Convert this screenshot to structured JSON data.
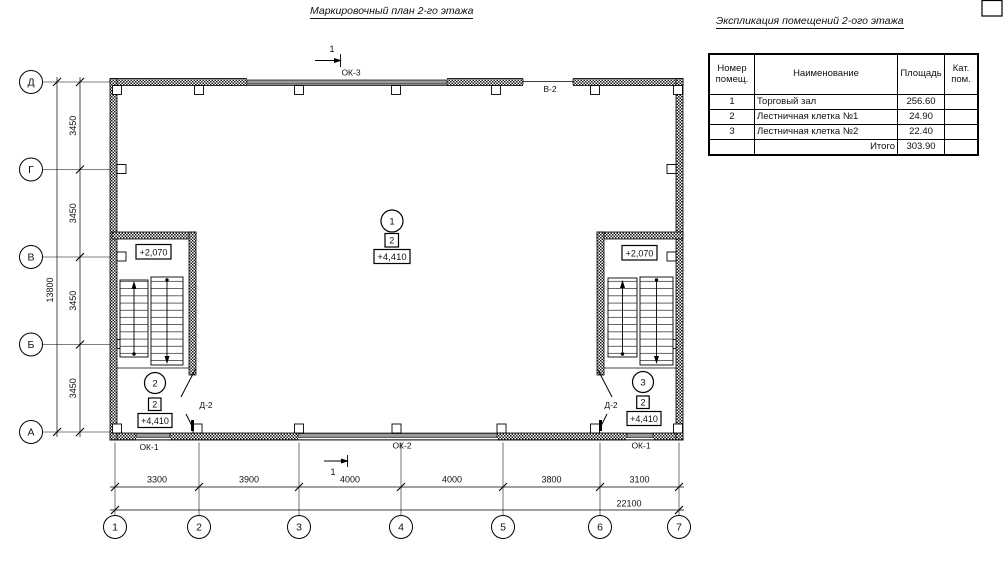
{
  "plan": {
    "title": "Маркировочный план 2-го этажа",
    "section_mark": "1",
    "labels": {
      "ok3": "ОК-3",
      "v2": "В-2",
      "ok1_left": "ОК-1",
      "ok2": "ОК-2",
      "ok1_right": "ОК-1",
      "d2_left": "Д-2",
      "d2_right": "Д-2"
    },
    "axes": {
      "rows": [
        "Д",
        "Г",
        "В",
        "Б",
        "А"
      ],
      "cols": [
        "1",
        "2",
        "3",
        "4",
        "5",
        "6",
        "7"
      ]
    },
    "dimensions": {
      "v_segments": [
        "3450",
        "3450",
        "3450",
        "3450"
      ],
      "v_total": "13800",
      "h_segments": [
        "3300",
        "3900",
        "4000",
        "4000",
        "3800",
        "3100"
      ],
      "h_total": "22100"
    },
    "markers": {
      "room1": {
        "number": "1",
        "category": "2",
        "elevation": "+4,410"
      },
      "room2": {
        "number": "2",
        "category": "2",
        "elevation": "+4,410"
      },
      "room3": {
        "number": "3",
        "category": "2",
        "elevation": "+4,410"
      },
      "landing_elevation_left": "+2,070",
      "landing_elevation_right": "+2,070"
    }
  },
  "explication": {
    "title": "Экспликация помещений 2-ого этажа",
    "headers": [
      "Номер помещ.",
      "Наименование",
      "Площадь",
      "Кат. пом."
    ],
    "rows": [
      {
        "num": "1",
        "name": "Торговый зал",
        "area": "256.60",
        "cat": ""
      },
      {
        "num": "2",
        "name": "Лестничная клетка №1",
        "area": "24.90",
        "cat": ""
      },
      {
        "num": "3",
        "name": "Лестничная клетка №2",
        "area": "22.40",
        "cat": ""
      }
    ],
    "total_label": "Итого",
    "total_area": "303.90"
  }
}
